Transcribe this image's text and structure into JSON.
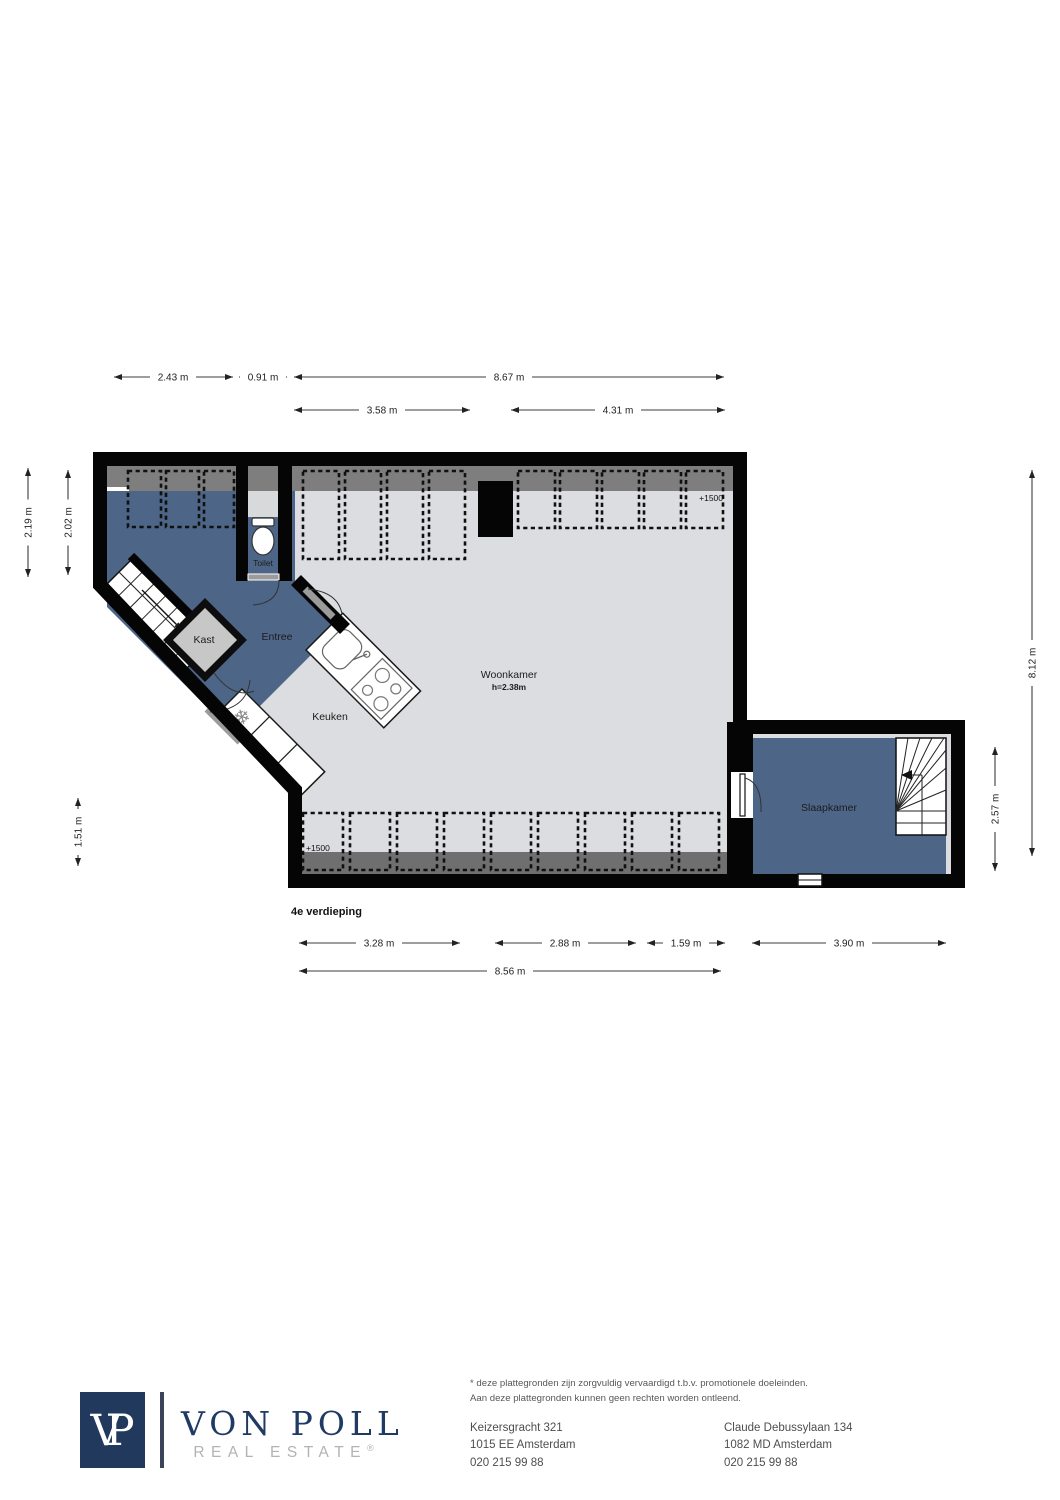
{
  "floorplan": {
    "floor_label": "4e verdieping",
    "rooms": {
      "woonkamer": "Woonkamer",
      "woonkamer_height": "h=2.38m",
      "keuken": "Keuken",
      "entree": "Entree",
      "kast": "Kast",
      "toilet": "Toilet",
      "slaapkamer": "Slaapkamer"
    },
    "level_markers": {
      "top": "+1500",
      "bottom": "+1500"
    },
    "dimensions": {
      "top_row1": [
        "2.43 m",
        "0.91 m",
        "8.67 m"
      ],
      "top_row2": [
        "3.58 m",
        "4.31 m"
      ],
      "left": [
        "2.19 m",
        "2.02 m"
      ],
      "left_lower": "1.51 m",
      "right": [
        "8.12 m",
        "2.57 m"
      ],
      "bottom_row1": [
        "3.28 m",
        "2.88 m",
        "1.59 m",
        "3.90 m"
      ],
      "bottom_row2": "8.56 m"
    },
    "icons": {
      "fridge_snowflake": "❄"
    },
    "colors": {
      "wall": "#000000",
      "floor": "#dcdde0",
      "room_blue": "#4d6586",
      "closet_gray": "#c7c7c7",
      "band_gray": "#7e7e7e",
      "bottom_strip_gray": "#6f6f6f"
    }
  },
  "footer": {
    "logo_initial_v": "V",
    "logo_initial_p": "P",
    "brand": "VON POLL",
    "tagline": "REAL ESTATE",
    "registered_mark": "®",
    "disclaimer_line1": "* deze plattegronden zijn zorgvuldig vervaardigd t.b.v. promotionele doeleinden.",
    "disclaimer_line2": "Aan deze plattegronden kunnen geen rechten worden ontleend.",
    "office_left": {
      "line1": "Keizersgracht 321",
      "line2": "1015 EE Amsterdam",
      "line3": "020 215 99 88"
    },
    "office_right": {
      "line1": "Claude Debussylaan 134",
      "line2": "1082 MD Amsterdam",
      "line3": "020 215 99 88"
    },
    "colors": {
      "navy": "#21395d",
      "brand_gray": "#b3b3b3"
    }
  }
}
